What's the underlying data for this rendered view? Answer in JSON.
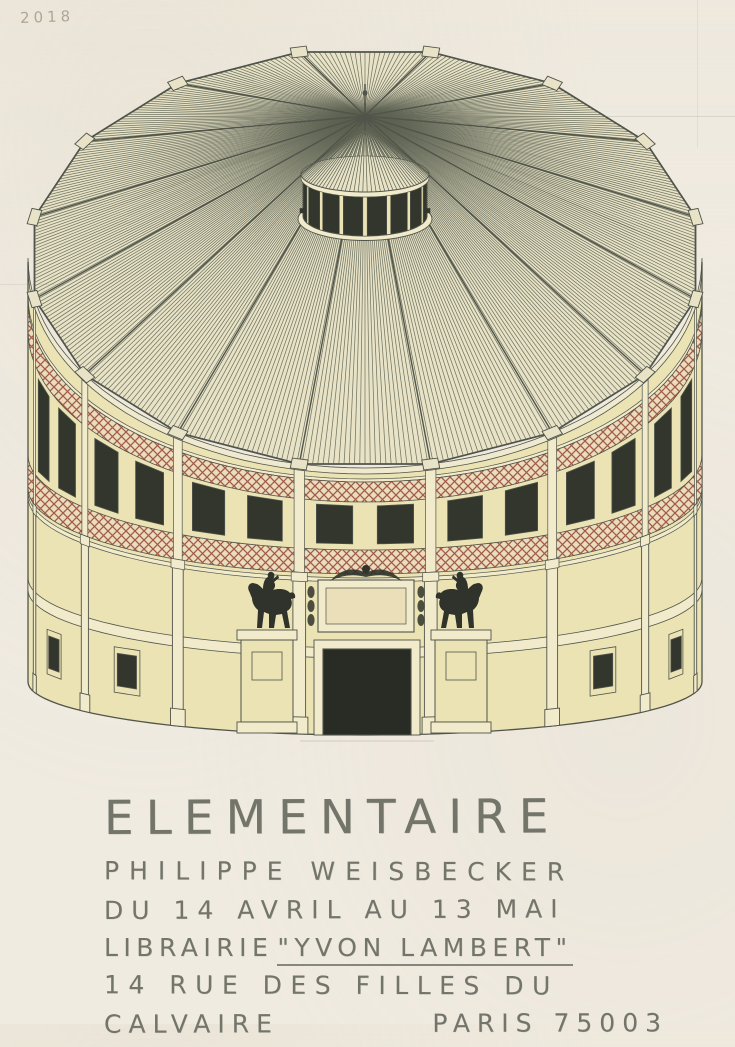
{
  "poster": {
    "year_annotation": "2018",
    "title": "ELEMENTAIRE",
    "artist": "PHILIPPE WEISBECKER",
    "dates": "DU 14 AVRIL AU 13 MAI",
    "venue_prefix": "LIBRAIRIE",
    "venue_name": "\"YVON LAMBERT\"",
    "address_line_1": "14 RUE DES FILLES DU",
    "address_line_2_left": "CALVAIRE",
    "address_line_2_right": "PARIS 75003"
  },
  "illustration": {
    "subject": "round pavilion with striped conical roof, lantern, equestrian statues and arched dark entrance"
  },
  "colors": {
    "paper": "#f0ebe1",
    "wall": "#ebe3b4",
    "wall_light": "#f1eacb",
    "fascia": "#efe9cf",
    "relief_bg": "#eadfb8",
    "roof_fill": "#e8e3c7",
    "roof_line": "#5d6252",
    "pencil": "#50544a",
    "hatch_red": "#a25b49",
    "hatch_bg": "#eaddbd",
    "dark": "#32362d",
    "door": "#292c24",
    "statue": "#2f332b",
    "text": "#73756b",
    "annotation": "#8d8776"
  }
}
